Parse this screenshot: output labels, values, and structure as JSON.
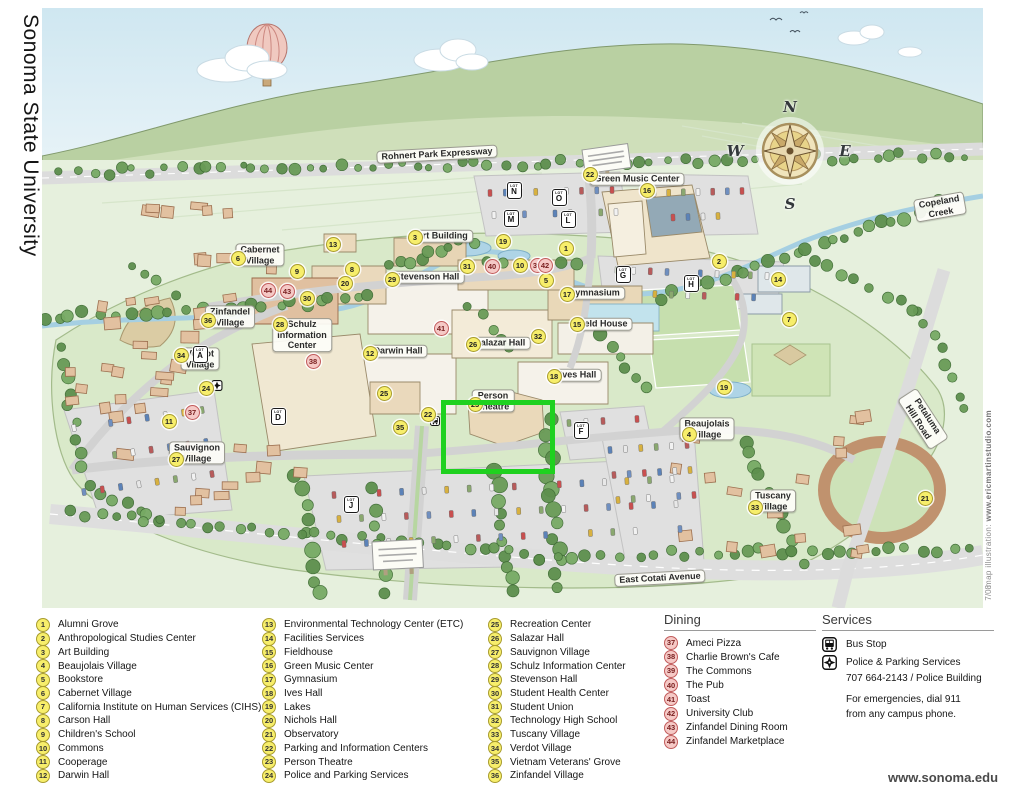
{
  "page": {
    "side_title": "Sonoma State University",
    "credit_label": "map illustration:  ",
    "credit_url": "www.ericmartinstudio.com",
    "credit_date": "7/08",
    "website": "www.sonoma.edu"
  },
  "map": {
    "compass": {
      "n": "N",
      "e": "E",
      "s": "S",
      "w": "W"
    },
    "highlight": {
      "x": 399,
      "y": 392,
      "w": 104,
      "h": 64,
      "color": "#1fd11f"
    },
    "labels": [
      {
        "text": "Rohnert Park Expressway",
        "x": 395,
        "y": 146,
        "rot": -3
      },
      {
        "text": "Copeland Creek",
        "x": 898,
        "y": 199,
        "rot": -10
      },
      {
        "text": "East Cotati Avenue",
        "x": 618,
        "y": 570,
        "rot": -3
      },
      {
        "text": "Petaluma Hill Road",
        "x": 881,
        "y": 411,
        "rot": 57
      },
      {
        "text": "Green Music Center",
        "x": 595,
        "y": 171,
        "rot": 0
      },
      {
        "text": "Art Building",
        "x": 400,
        "y": 228,
        "rot": 0
      },
      {
        "text": "Cabernet\nVillage",
        "x": 218,
        "y": 247,
        "rot": 0
      },
      {
        "text": "Zinfandel\nVillage",
        "x": 188,
        "y": 309,
        "rot": 0
      },
      {
        "text": "Verdot\nVillage",
        "x": 158,
        "y": 351,
        "rot": 0
      },
      {
        "text": "Schulz\nInformation\nCenter",
        "x": 260,
        "y": 327,
        "rot": 0
      },
      {
        "text": "Stevenson Hall",
        "x": 385,
        "y": 269,
        "rot": 0
      },
      {
        "text": "Darwin Hall",
        "x": 356,
        "y": 343,
        "rot": 0
      },
      {
        "text": "Salazar Hall",
        "x": 458,
        "y": 335,
        "rot": 0
      },
      {
        "text": "Gymnasium",
        "x": 552,
        "y": 285,
        "rot": 0
      },
      {
        "text": "Field House",
        "x": 560,
        "y": 316,
        "rot": 0
      },
      {
        "text": "Ives Hall",
        "x": 536,
        "y": 367,
        "rot": 0
      },
      {
        "text": "Person\nTheatre",
        "x": 451,
        "y": 393,
        "rot": 0
      },
      {
        "text": "Beaujolais\nVillage",
        "x": 665,
        "y": 421,
        "rot": 0
      },
      {
        "text": "Tuscany\nVillage",
        "x": 731,
        "y": 493,
        "rot": 0
      },
      {
        "text": "Sauvignon\nVillage",
        "x": 155,
        "y": 445,
        "rot": 0
      }
    ],
    "markers": [
      {
        "n": "1",
        "x": 523,
        "y": 239
      },
      {
        "n": "2",
        "x": 676,
        "y": 252
      },
      {
        "n": "3",
        "x": 372,
        "y": 228
      },
      {
        "n": "4",
        "x": 646,
        "y": 425
      },
      {
        "n": "5",
        "x": 503,
        "y": 271
      },
      {
        "n": "6",
        "x": 195,
        "y": 249
      },
      {
        "n": "7",
        "x": 746,
        "y": 310
      },
      {
        "n": "8",
        "x": 309,
        "y": 260
      },
      {
        "n": "9",
        "x": 254,
        "y": 262
      },
      {
        "n": "10",
        "x": 477,
        "y": 256
      },
      {
        "n": "11",
        "x": 126,
        "y": 412
      },
      {
        "n": "12",
        "x": 327,
        "y": 344
      },
      {
        "n": "13",
        "x": 290,
        "y": 235
      },
      {
        "n": "14",
        "x": 735,
        "y": 270
      },
      {
        "n": "15",
        "x": 534,
        "y": 315
      },
      {
        "n": "16",
        "x": 604,
        "y": 181
      },
      {
        "n": "17",
        "x": 524,
        "y": 285
      },
      {
        "n": "18",
        "x": 511,
        "y": 367
      },
      {
        "n": "19",
        "x": 460,
        "y": 232
      },
      {
        "n": "19",
        "x": 681,
        "y": 378
      },
      {
        "n": "20",
        "x": 302,
        "y": 274
      },
      {
        "n": "21",
        "x": 882,
        "y": 489
      },
      {
        "n": "22",
        "x": 547,
        "y": 165
      },
      {
        "n": "22",
        "x": 385,
        "y": 405
      },
      {
        "n": "23",
        "x": 432,
        "y": 395
      },
      {
        "n": "24",
        "x": 163,
        "y": 379
      },
      {
        "n": "25",
        "x": 341,
        "y": 384
      },
      {
        "n": "26",
        "x": 430,
        "y": 335
      },
      {
        "n": "27",
        "x": 133,
        "y": 450
      },
      {
        "n": "28",
        "x": 237,
        "y": 315
      },
      {
        "n": "29",
        "x": 349,
        "y": 270
      },
      {
        "n": "30",
        "x": 264,
        "y": 289
      },
      {
        "n": "31",
        "x": 424,
        "y": 257
      },
      {
        "n": "32",
        "x": 495,
        "y": 327
      },
      {
        "n": "33",
        "x": 712,
        "y": 498
      },
      {
        "n": "34",
        "x": 138,
        "y": 346
      },
      {
        "n": "35",
        "x": 357,
        "y": 418
      },
      {
        "n": "36",
        "x": 165,
        "y": 311
      },
      {
        "n": "37",
        "x": 149,
        "y": 403,
        "c": "pink"
      },
      {
        "n": "38",
        "x": 270,
        "y": 352,
        "c": "pink"
      },
      {
        "n": "39",
        "x": 494,
        "y": 256,
        "c": "pink"
      },
      {
        "n": "40",
        "x": 449,
        "y": 257,
        "c": "pink"
      },
      {
        "n": "41",
        "x": 398,
        "y": 319,
        "c": "pink"
      },
      {
        "n": "42",
        "x": 502,
        "y": 256,
        "c": "pink"
      },
      {
        "n": "43",
        "x": 244,
        "y": 282,
        "c": "pink"
      },
      {
        "n": "44",
        "x": 225,
        "y": 281,
        "c": "pink"
      }
    ],
    "parking_lots": [
      {
        "letter": "A",
        "x": 157,
        "y": 345
      },
      {
        "letter": "D",
        "x": 235,
        "y": 407
      },
      {
        "letter": "J",
        "x": 308,
        "y": 495
      },
      {
        "letter": "M",
        "x": 468,
        "y": 209
      },
      {
        "letter": "N",
        "x": 471,
        "y": 181
      },
      {
        "letter": "O",
        "x": 516,
        "y": 188
      },
      {
        "letter": "L",
        "x": 525,
        "y": 210
      },
      {
        "letter": "G",
        "x": 580,
        "y": 265
      },
      {
        "letter": "H",
        "x": 648,
        "y": 274
      },
      {
        "letter": "F",
        "x": 538,
        "y": 421
      }
    ]
  },
  "legend": {
    "columns": [
      [
        {
          "n": "1",
          "label": "Alumni Grove"
        },
        {
          "n": "2",
          "label": "Anthropological Studies Center"
        },
        {
          "n": "3",
          "label": "Art Building"
        },
        {
          "n": "4",
          "label": "Beaujolais Village"
        },
        {
          "n": "5",
          "label": "Bookstore"
        },
        {
          "n": "6",
          "label": "Cabernet Village"
        },
        {
          "n": "7",
          "label": "California Institute on Human Services  (CIHS)"
        },
        {
          "n": "8",
          "label": "Carson Hall"
        },
        {
          "n": "9",
          "label": "Children's School"
        },
        {
          "n": "10",
          "label": "Commons"
        },
        {
          "n": "11",
          "label": "Cooperage"
        },
        {
          "n": "12",
          "label": "Darwin Hall"
        }
      ],
      [
        {
          "n": "13",
          "label": "Environmental Technology Center  (ETC)"
        },
        {
          "n": "14",
          "label": "Facilities Services"
        },
        {
          "n": "15",
          "label": "Fieldhouse"
        },
        {
          "n": "16",
          "label": "Green Music Center"
        },
        {
          "n": "17",
          "label": "Gymnasium"
        },
        {
          "n": "18",
          "label": "Ives Hall"
        },
        {
          "n": "19",
          "label": "Lakes"
        },
        {
          "n": "20",
          "label": "Nichols Hall"
        },
        {
          "n": "21",
          "label": "Observatory"
        },
        {
          "n": "22",
          "label": "Parking and Information Centers"
        },
        {
          "n": "23",
          "label": "Person Theatre"
        },
        {
          "n": "24",
          "label": "Police and Parking Services"
        }
      ],
      [
        {
          "n": "25",
          "label": "Recreation Center"
        },
        {
          "n": "26",
          "label": "Salazar Hall"
        },
        {
          "n": "27",
          "label": "Sauvignon Village"
        },
        {
          "n": "28",
          "label": "Schulz Information Center"
        },
        {
          "n": "29",
          "label": "Stevenson Hall"
        },
        {
          "n": "30",
          "label": "Student Health Center"
        },
        {
          "n": "31",
          "label": "Student Union"
        },
        {
          "n": "32",
          "label": "Technology High School"
        },
        {
          "n": "33",
          "label": "Tuscany Village"
        },
        {
          "n": "34",
          "label": "Verdot Village"
        },
        {
          "n": "35",
          "label": "Vietnam Veterans' Grove"
        },
        {
          "n": "36",
          "label": "Zinfandel Village"
        }
      ]
    ],
    "dining": {
      "title": "Dining",
      "items": [
        {
          "n": "37",
          "label": "Ameci Pizza"
        },
        {
          "n": "38",
          "label": "Charlie Brown's Cafe"
        },
        {
          "n": "39",
          "label": "The Commons"
        },
        {
          "n": "40",
          "label": "The Pub"
        },
        {
          "n": "41",
          "label": "Toast"
        },
        {
          "n": "42",
          "label": "University Club"
        },
        {
          "n": "43",
          "label": "Zinfandel Dining Room"
        },
        {
          "n": "44",
          "label": "Zinfandel Marketplace"
        }
      ]
    },
    "services": {
      "title": "Services",
      "bus_label": "Bus Stop",
      "police_label": "Police & Parking Services",
      "police_info": "707 664-2143 / Police Building",
      "emergency_line1": "For emergencies, dial 911",
      "emergency_line2": "from any campus phone."
    }
  }
}
